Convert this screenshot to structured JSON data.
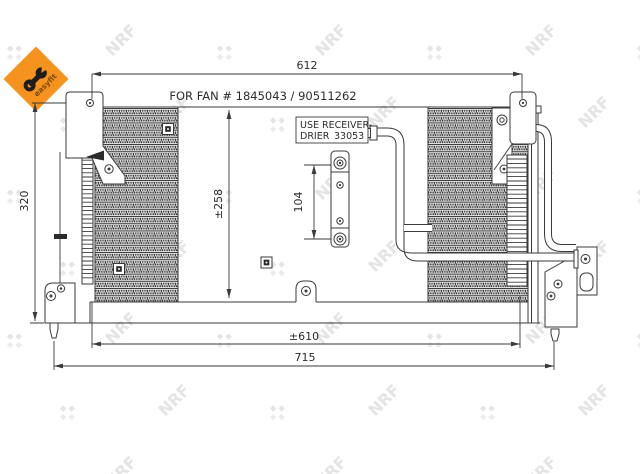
{
  "drawing": {
    "fan_note": "FOR FAN # 1845043 / 90511262",
    "receiver_box": {
      "line1": "USE RECEIVER-",
      "line2_label": "DRIER",
      "line2_part": "33053"
    },
    "dimensions": {
      "top_width": "612",
      "left_height": "320",
      "core_height": "±258",
      "bracket_pitch": "104",
      "lower_width": "±610",
      "total_width": "715"
    }
  },
  "branding": {
    "watermark_text": "NRF",
    "logo_text": "easyfit"
  },
  "colors": {
    "line": "#3a3a3a",
    "text": "#2b2b2b",
    "watermark": "#e4e4e4",
    "logo_orange": "#f6921e",
    "logo_text_color": "#7b4a10",
    "background": "#ffffff"
  }
}
